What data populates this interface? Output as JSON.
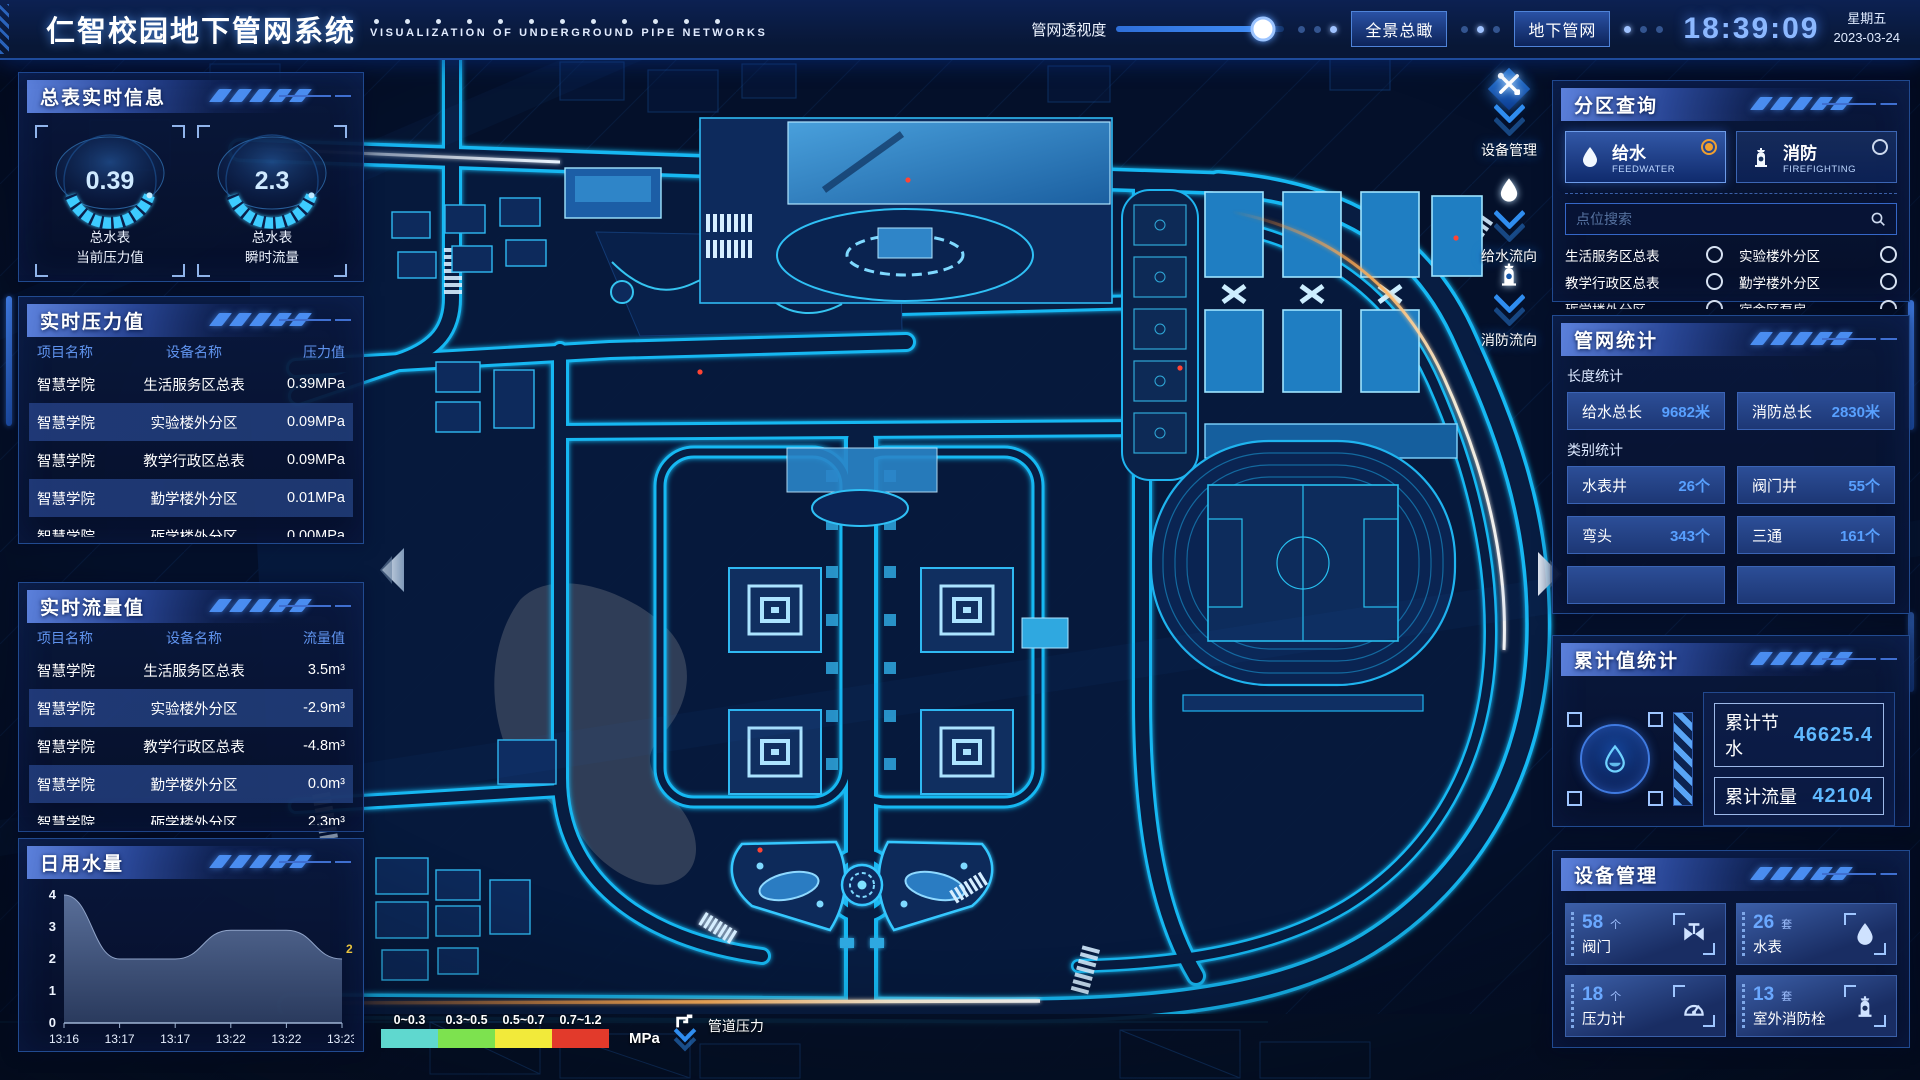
{
  "header": {
    "title": "仁智校园地下管网系统",
    "subtitle": "VISUALIZATION OF UNDERGROUND PIPE NETWORKS",
    "slider_label": "管网透视度",
    "slider_percent": 87,
    "btn_overview": "全景总瞰",
    "btn_underground": "地下管网",
    "time": "18:39:09",
    "weekday": "星期五",
    "date": "2023-03-24"
  },
  "left": {
    "meter": {
      "title": "总表实时信息",
      "gauges": [
        {
          "value": "0.39",
          "line1": "总水表",
          "line2": "当前压力值"
        },
        {
          "value": "2.3",
          "line1": "总水表",
          "line2": "瞬时流量"
        }
      ]
    },
    "pressure": {
      "title": "实时压力值",
      "headers": [
        "项目名称",
        "设备名称",
        "压力值"
      ],
      "rows": [
        [
          "智慧学院",
          "生活服务区总表",
          "0.39MPa"
        ],
        [
          "智慧学院",
          "实验楼外分区",
          "0.09MPa"
        ],
        [
          "智慧学院",
          "教学行政区总表",
          "0.09MPa"
        ],
        [
          "智慧学院",
          "勤学楼外分区",
          "0.01MPa"
        ],
        [
          "智慧学院",
          "砺学楼外分区",
          "0.00MPa"
        ]
      ]
    },
    "flow": {
      "title": "实时流量值",
      "headers": [
        "项目名称",
        "设备名称",
        "流量值"
      ],
      "rows": [
        [
          "智慧学院",
          "生活服务区总表",
          "3.5m³"
        ],
        [
          "智慧学院",
          "实验楼外分区",
          "-2.9m³"
        ],
        [
          "智慧学院",
          "教学行政区总表",
          "-4.8m³"
        ],
        [
          "智慧学院",
          "勤学楼外分区",
          "0.0m³"
        ],
        [
          "智慧学院",
          "砺学楼外分区",
          "2.3m³"
        ]
      ]
    },
    "daily": {
      "title": "日用水量"
    }
  },
  "chart_data": {
    "type": "area",
    "title": "日用水量",
    "x": [
      "13:16",
      "13:17",
      "13:17",
      "13:22",
      "13:22",
      "13:23"
    ],
    "values": [
      4,
      2,
      2,
      2.9,
      2.9,
      2
    ],
    "ylim": [
      0,
      4
    ],
    "yticks": [
      4,
      3,
      2,
      1,
      0
    ],
    "end_label": "2",
    "grid": false,
    "legend_position": "none"
  },
  "right": {
    "zone": {
      "title": "分区查询",
      "tabs": [
        {
          "cn": "给水",
          "en": "FEEDWATER",
          "active": true
        },
        {
          "cn": "消防",
          "en": "FIREFIGHTING",
          "active": false
        }
      ],
      "search_placeholder": "点位搜索",
      "items": [
        "生活服务区总表",
        "实验楼外分区",
        "教学行政区总表",
        "勤学楼外分区",
        "砺学楼外分区",
        "宿舍区泵房"
      ]
    },
    "network": {
      "title": "管网统计",
      "len_label": "长度统计",
      "cat_label": "类别统计",
      "len_stats": [
        {
          "label": "给水总长",
          "value": "9682米"
        },
        {
          "label": "消防总长",
          "value": "2830米"
        }
      ],
      "cat_stats": [
        {
          "label": "水表井",
          "value": "26个"
        },
        {
          "label": "阀门井",
          "value": "55个"
        },
        {
          "label": "弯头",
          "value": "343个"
        },
        {
          "label": "三通",
          "value": "161个"
        }
      ]
    },
    "total": {
      "title": "累计值统计",
      "rows": [
        {
          "label": "累计节水",
          "value": "46625.4"
        },
        {
          "label": "累计流量",
          "value": "42104"
        }
      ]
    },
    "device": {
      "title": "设备管理",
      "cards": [
        {
          "count": "58",
          "unit": "个",
          "label": "阀门",
          "icon": "valve-icon"
        },
        {
          "count": "26",
          "unit": "套",
          "label": "水表",
          "icon": "water-meter-icon"
        },
        {
          "count": "18",
          "unit": "个",
          "label": "压力计",
          "icon": "pressure-gauge-icon"
        },
        {
          "count": "13",
          "unit": "套",
          "label": "室外消防栓",
          "icon": "hydrant-icon"
        }
      ]
    }
  },
  "map": {
    "tools": [
      {
        "label": "设备管理",
        "icon": "tools-icon"
      },
      {
        "label": "给水流向",
        "icon": "water-drop-icon"
      },
      {
        "label": "消防流向",
        "icon": "hydrant-icon"
      }
    ],
    "legend": {
      "ranges": [
        "0~0.3",
        "0.3~0.5",
        "0.5~0.7",
        "0.7~1.2"
      ],
      "colors": [
        "#5fd8cf",
        "#7de24f",
        "#f2ea3a",
        "#e23a2b"
      ],
      "unit": "MPa",
      "label": "管道压力"
    }
  }
}
